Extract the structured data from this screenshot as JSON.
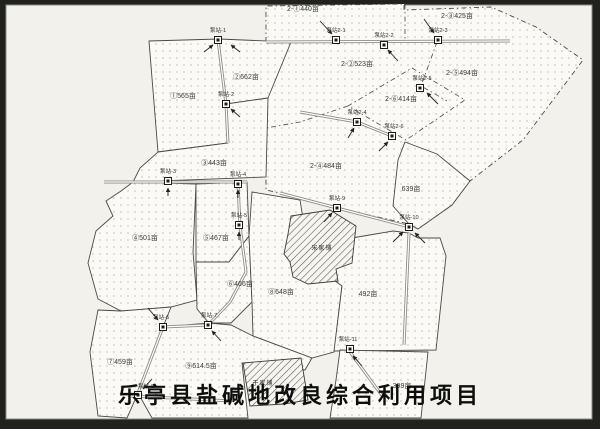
{
  "title": "乐亭县盐碱地改良综合利用项目",
  "parcels": [
    {
      "label": "①565亩"
    },
    {
      "label": "②662亩"
    },
    {
      "label": "③443亩"
    },
    {
      "label": "④501亩"
    },
    {
      "label": "⑤467亩"
    },
    {
      "label": "⑥466亩"
    },
    {
      "label": "⑦459亩"
    },
    {
      "label": "⑧648亩"
    },
    {
      "label": "⑨614.5亩"
    },
    {
      "label": "639亩"
    },
    {
      "label": "492亩"
    },
    {
      "label": "399亩"
    }
  ],
  "parcels_zone2": [
    {
      "label": "2-①440亩"
    },
    {
      "label": "2-②523亩"
    },
    {
      "label": "2-③425亩"
    },
    {
      "label": "2-④484亩"
    },
    {
      "label": "2-⑤494亩"
    },
    {
      "label": "2-⑥414亩"
    }
  ],
  "pump_stations": [
    {
      "label": "泵站-1"
    },
    {
      "label": "泵站-2"
    },
    {
      "label": "泵站-3"
    },
    {
      "label": "泵站-4"
    },
    {
      "label": "泵站-5"
    },
    {
      "label": "泵站-6"
    },
    {
      "label": "泵站-7"
    },
    {
      "label": "泵站-8"
    },
    {
      "label": "泵站-9"
    },
    {
      "label": "泵站-10"
    },
    {
      "label": "泵站-11"
    },
    {
      "label": "泵站2-1"
    },
    {
      "label": "泵站2-2"
    },
    {
      "label": "泵站2-3"
    },
    {
      "label": "泵站2-4"
    },
    {
      "label": "泵站2-5"
    },
    {
      "label": "泵站2-6"
    }
  ],
  "villages": [
    {
      "name": "宋家铺"
    },
    {
      "name": "于家铺"
    }
  ],
  "colors": {
    "paper": "#f2f1ec",
    "parcel_fill": "#fbfaf6",
    "line": "#4a4a45",
    "frame": "#21211e",
    "pipe": "#8d8d86",
    "title_text": "#0e0e0c"
  }
}
